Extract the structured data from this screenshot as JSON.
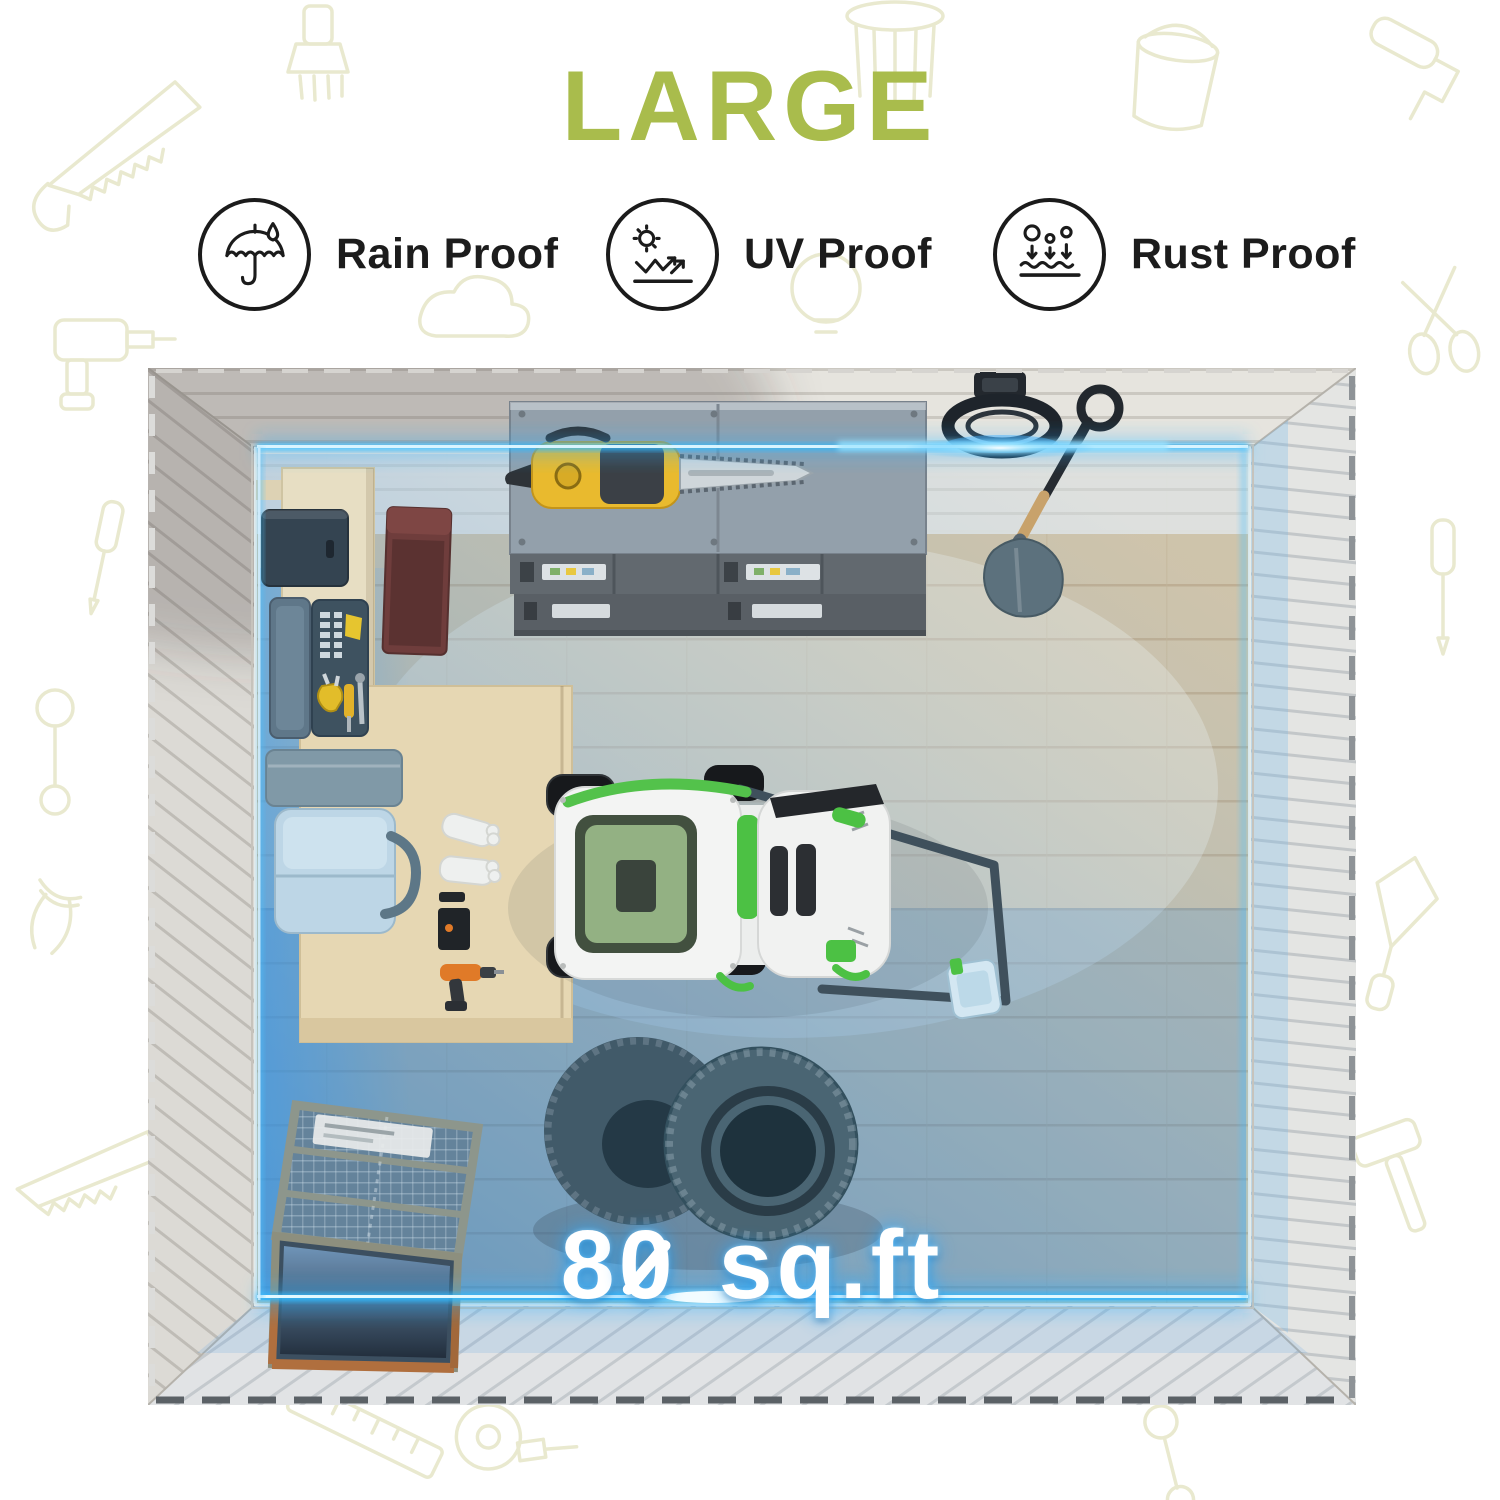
{
  "header": {
    "title": "LARGE",
    "title_color": "#a9bc4c"
  },
  "features": [
    {
      "id": "rain-proof",
      "label": "Rain Proof",
      "icon": "umbrella-raindrop-icon"
    },
    {
      "id": "uv-proof",
      "label": "UV Proof",
      "icon": "sun-uv-reflection-icon"
    },
    {
      "id": "rust-proof",
      "label": "Rust Proof",
      "icon": "rust-particles-surface-icon"
    }
  ],
  "photo": {
    "area_label": "80 sq.ft",
    "area_parts": {
      "tens": "8",
      "ones": "0",
      "unit": "sq.ft"
    },
    "accent_glow_color": "#31bbff",
    "hologram_color": "#1f7fd6",
    "floor_color": "#d6c4a4",
    "objects": [
      "metal-tool-cabinet",
      "chainsaw",
      "hose-reel",
      "shovel",
      "wall-workbench",
      "dark-storage-box",
      "open-toolbox",
      "red-side-cabinet",
      "storage-box",
      "cooler-box",
      "work-table",
      "work-gloves",
      "tool-case",
      "power-drill",
      "lawn-mower",
      "spare-tires",
      "wooden-mesh-crate"
    ]
  }
}
